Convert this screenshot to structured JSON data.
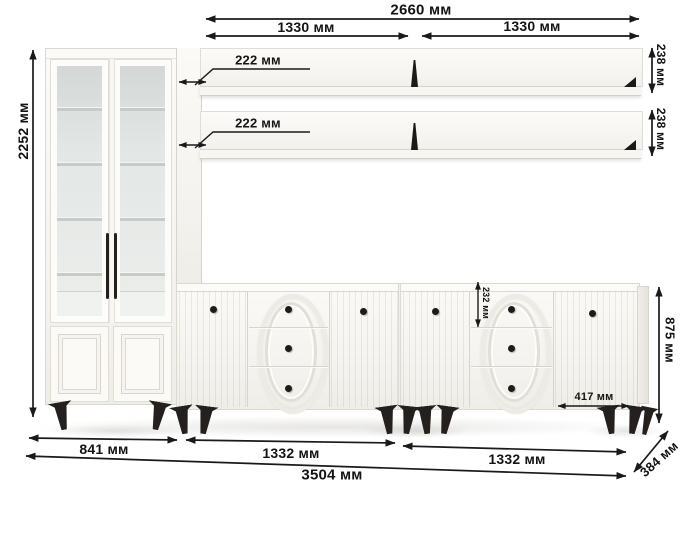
{
  "dimensions": {
    "overall_width": "2660 мм",
    "shelf_width_left": "1330 мм",
    "shelf_width_right": "1330 мм",
    "shelf_depth_top": "222 мм",
    "shelf_depth_bottom": "222 мм",
    "shelf_height_top": "238 мм",
    "shelf_height_bottom": "238 мм",
    "cabinet_height": "2252 мм",
    "drawer_height": "232 мм",
    "door_width": "417 мм",
    "sideboard_height": "875 мм",
    "cabinet_width": "841 мм",
    "sideboard_width_left": "1332 мм",
    "sideboard_width_right": "1332 мм",
    "total_width": "3504 мм",
    "depth": "384 мм"
  }
}
